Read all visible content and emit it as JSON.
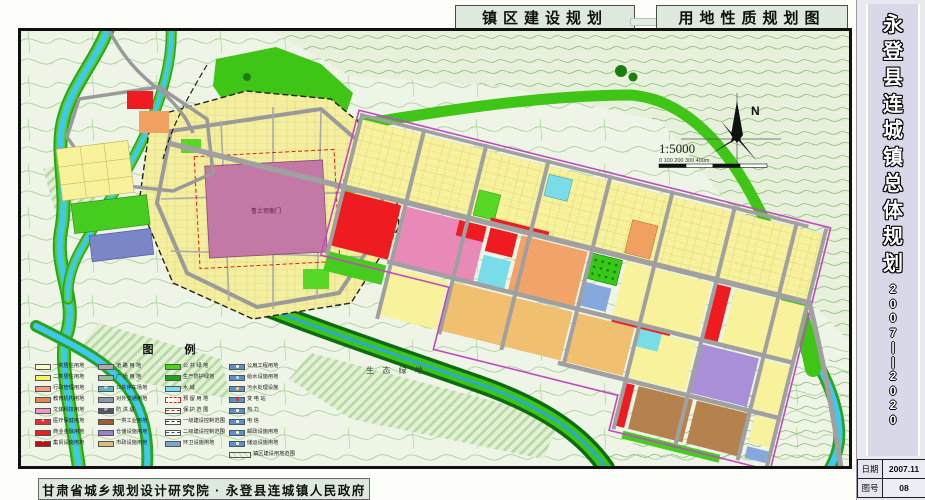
{
  "titles": {
    "left": "镇区建设规划",
    "right": "用地性质规划图"
  },
  "sidebar": {
    "title_chars": [
      "永",
      "登",
      "县",
      "连",
      "城",
      "镇",
      "总",
      "体",
      "规",
      "划"
    ],
    "years_chars": [
      "2",
      "0",
      "0",
      "7",
      "|",
      "|",
      "2",
      "0",
      "2",
      "0"
    ],
    "info_rows": [
      {
        "label": "日期",
        "value": "2007.11"
      },
      {
        "label": "图号",
        "value": "08"
      }
    ]
  },
  "footer": {
    "credit": "甘肃省城乡规划设计研究院 · 永登县连城镇人民政府"
  },
  "map": {
    "labels": {
      "heritage": "鲁土司衙门",
      "eco_green": "生 态 绿 地",
      "north": "N",
      "scale": "1:5000",
      "scale_ticks": "0    100    200    300   400m"
    },
    "colors": {
      "water": "#3fc9ef",
      "public_green": "#3fc516",
      "residential1": "#fdfdc8",
      "residential2": "#f7f29b",
      "commercial": "#ee1c20",
      "culture": "#e989b8",
      "education": "#f2a468",
      "industry_tan": "#f0c070",
      "industry_brown": "#b5824e",
      "warehouse": "#a98fd8",
      "road": "#a0a0a0",
      "heritage_block": "#c279a6"
    }
  },
  "legend": {
    "header": "图   例",
    "columns": [
      {
        "items": [
          {
            "label": "一类居住用地",
            "type": "fill",
            "color": "#fdfdc8"
          },
          {
            "label": "二类居住用地",
            "type": "fill",
            "color": "#faf55e"
          },
          {
            "label": "行政管理用地",
            "type": "fill",
            "color": "#f4a080"
          },
          {
            "label": "教育机构用地",
            "type": "fill",
            "color": "#e8854e"
          },
          {
            "label": "文体科技用地",
            "type": "fill",
            "color": "#f298c2"
          },
          {
            "label": "医疗保健用地",
            "type": "fill",
            "color": "#e43030",
            "sym": "+",
            "symColor": "#ffffff"
          },
          {
            "label": "商业金融用地",
            "type": "fill",
            "color": "#ee1c20"
          },
          {
            "label": "集贸设施用地",
            "type": "fill",
            "color": "#c40d10",
            "sym": "*",
            "symColor": "#ffffff"
          }
        ]
      },
      {
        "items": [
          {
            "label": "道 路 用 地",
            "type": "fill",
            "color": "#ababab"
          },
          {
            "label": "广 场 用 地",
            "type": "fill",
            "color": "#8fbf8f"
          },
          {
            "label": "公共停车场地",
            "type": "fill",
            "color": "#58b8c8",
            "sym": "P",
            "symColor": "#ffffff"
          },
          {
            "label": "对外交通用地",
            "type": "fill",
            "color": "#8897aa"
          },
          {
            "label": "防  洪  堤",
            "type": "fill",
            "color": "#4e5868",
            "sym": "P",
            "symColor": "#ffffff"
          },
          {
            "label": "一类工业用地",
            "type": "fill",
            "color": "#9c5c34"
          },
          {
            "label": "仓储设施用地",
            "type": "fill",
            "color": "#9b7fd4"
          },
          {
            "label": "市政设施用地",
            "type": "fill",
            "color": "#e0b878"
          }
        ]
      },
      {
        "items": [
          {
            "label": "公 共 绿 地",
            "type": "fill",
            "color": "#46d818"
          },
          {
            "label": "生产防护绿地",
            "type": "fill",
            "color": "#18a818"
          },
          {
            "label": "水      域",
            "type": "fill",
            "color": "#74e0f0"
          },
          {
            "label": "预 留 用 地",
            "type": "reserve",
            "color": "#fbfbf2"
          },
          {
            "label": "保 护 范 围",
            "type": "line",
            "lineColor": "#e02020",
            "dash": "dashed"
          },
          {
            "label": "一级建设控制范围",
            "type": "line",
            "lineColor": "#303030",
            "dash": "dashed"
          },
          {
            "label": "二级建设控制范围",
            "type": "line",
            "lineColor": "#2050c0",
            "dash": "dashed"
          },
          {
            "label": "环卫设施用地",
            "type": "fill",
            "color": "#78a8d0"
          }
        ]
      },
      {
        "items": [
          {
            "label": "公用工程用地",
            "type": "fill",
            "color": "#5b8fd0",
            "dot": "#ffffff"
          },
          {
            "label": "给水设施用地",
            "type": "fill",
            "color": "#5b8fd0",
            "dot": "#aef0ff"
          },
          {
            "label": "污水处理设施",
            "type": "fill",
            "color": "#5b8fd0",
            "dot": "#ffe24a"
          },
          {
            "label": "变  电  站",
            "type": "fill",
            "color": "#5b8fd0",
            "dot": "#ff2020"
          },
          {
            "label": "热      力",
            "type": "fill",
            "color": "#5b8fd0",
            "dot": "#ffffff"
          },
          {
            "label": "电      信",
            "type": "fill",
            "color": "#5b8fd0",
            "dot": "#ffffff"
          },
          {
            "label": "邮政设施用地",
            "type": "fill",
            "color": "#5b8fd0",
            "dot": "#ffffff"
          },
          {
            "label": "储运设施用地",
            "type": "fill",
            "color": "#5b8fd0",
            "dot": "#ffffff"
          },
          {
            "label": "镇区建设用地范围",
            "type": "hatch"
          }
        ]
      }
    ]
  }
}
